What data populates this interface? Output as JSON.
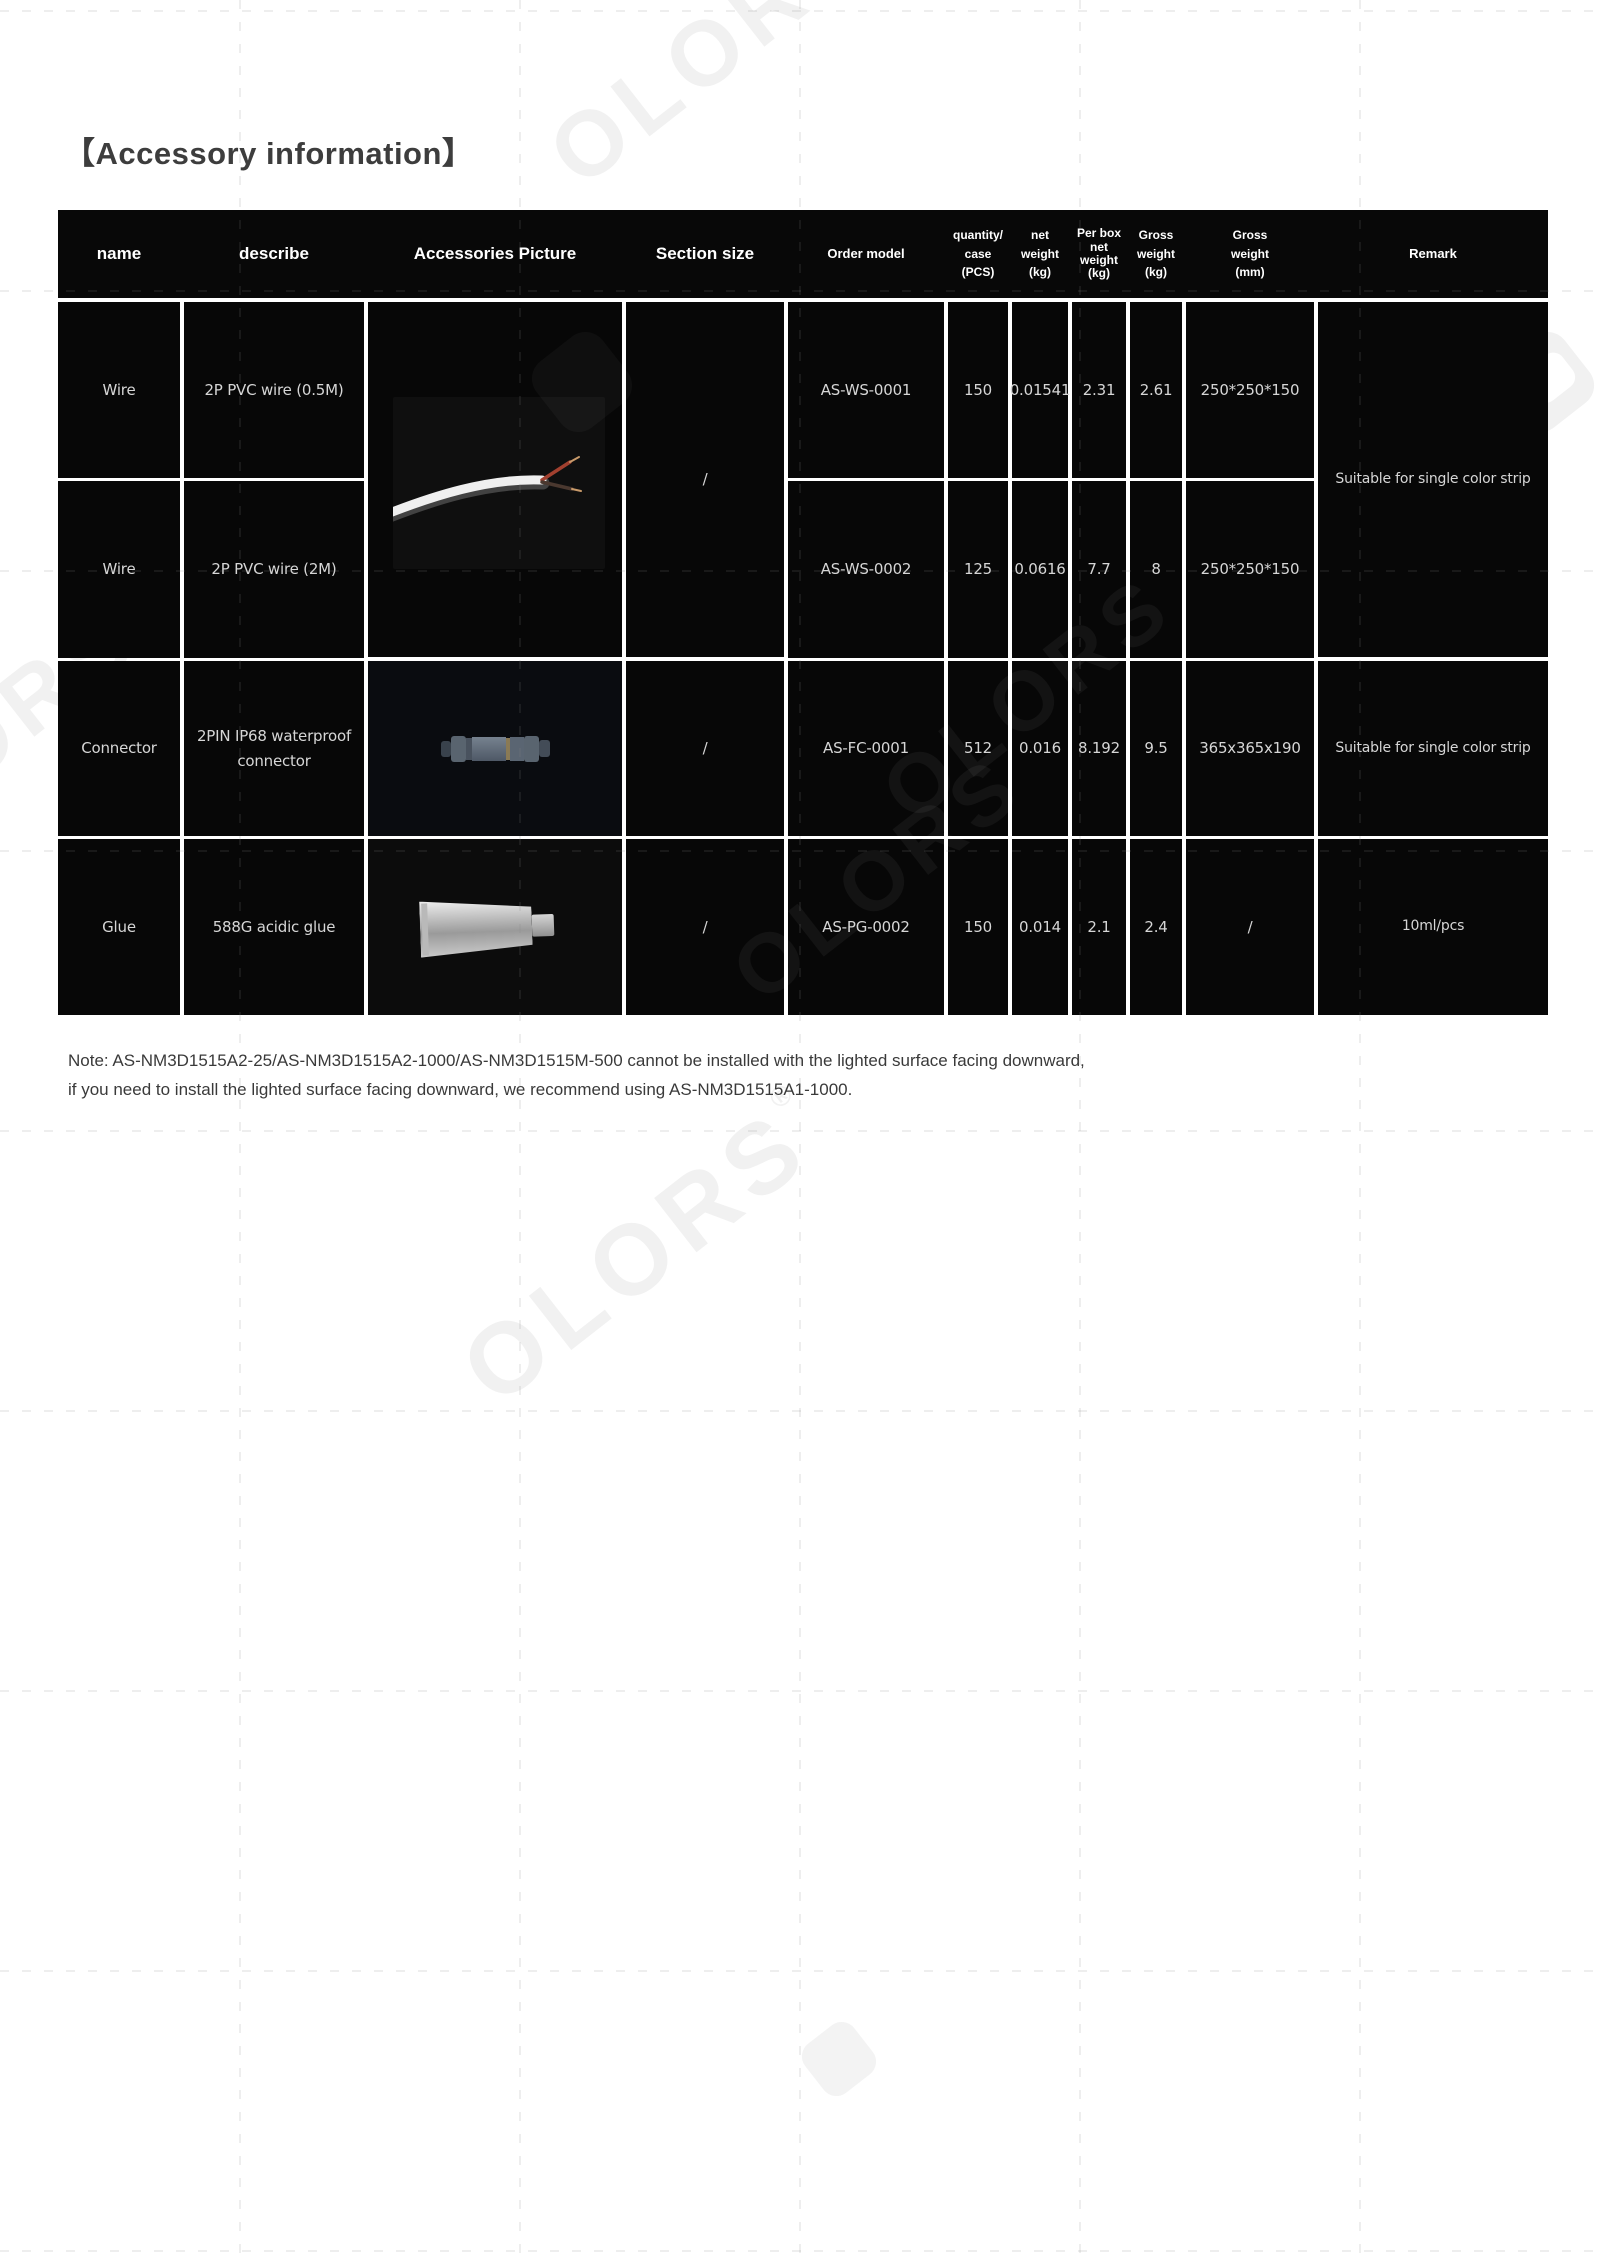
{
  "page": {
    "title": "【Accessory information】",
    "note_line1": "Note: AS-NM3D1515A2-25/AS-NM3D1515A2-1000/AS-NM3D1515M-500 cannot be installed with the lighted surface facing downward,",
    "note_line2": "if you need to install the lighted surface facing downward, we recommend using AS-NM3D1515A1-1000.",
    "colors": {
      "page_bg": "#ffffff",
      "title_text": "#3d3d3d",
      "cell_bg": "#070707",
      "header_text": "#ffffff",
      "value_text": "#d6d6d6",
      "wire_red": "#a2402f"
    }
  },
  "watermark": {
    "text": "OLORS",
    "reg": "®"
  },
  "table": {
    "headers": {
      "name": "name",
      "describe": "describe",
      "picture": "Accessories Picture",
      "section": "Section size",
      "order": "Order model",
      "quantity": "quantity/\ncase\n(PCS)",
      "net": "net\nweight\n(kg)",
      "perbox": "Per box\nnet\nweight\n(kg)",
      "gross_kg": "Gross\nweight\n(kg)",
      "gross_mm": "Gross\nweight\n(mm)",
      "remark": "Remark"
    },
    "merged": {
      "section_rows12": "/",
      "remark_rows12": "Suitable for single color strip"
    },
    "rows": [
      {
        "name": "Wire",
        "describe": "2P PVC wire (0.5M)",
        "order": "AS-WS-0001",
        "quantity": "150",
        "net": "0.01541",
        "perbox": "2.31",
        "gross_kg": "2.61",
        "gross_mm": "250*250*150"
      },
      {
        "name": "Wire",
        "describe": "2P PVC wire (2M)",
        "order": "AS-WS-0002",
        "quantity": "125",
        "net": "0.0616",
        "perbox": "7.7",
        "gross_kg": "8",
        "gross_mm": "250*250*150"
      },
      {
        "name": "Connector",
        "describe": "2PIN IP68 waterproof\nconnector",
        "section": "/",
        "order": "AS-FC-0001",
        "quantity": "512",
        "net": "0.016",
        "perbox": "8.192",
        "gross_kg": "9.5",
        "gross_mm": "365x365x190",
        "remark": "Suitable for single color strip"
      },
      {
        "name": "Glue",
        "describe": "588G acidic glue",
        "section": "/",
        "order": "AS-PG-0002",
        "quantity": "150",
        "net": "0.014",
        "perbox": "2.1",
        "gross_kg": "2.4",
        "gross_mm": "/",
        "remark": "10ml/pcs"
      }
    ]
  }
}
